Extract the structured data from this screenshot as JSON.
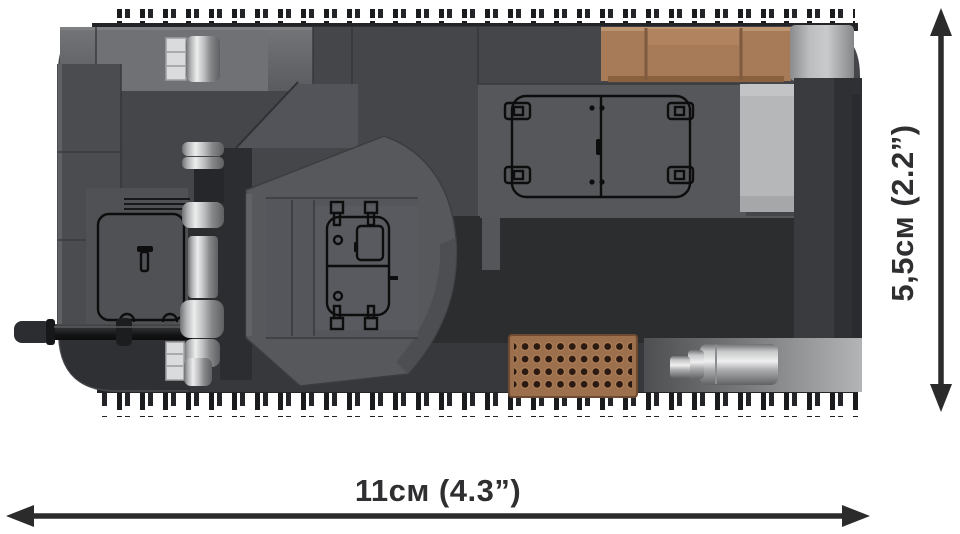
{
  "meta": {
    "description": "Product dimension image: top view of a brick-built (COBI-style) grey tank model with black dimension arrows on white background",
    "view": "top",
    "background": "#ffffff"
  },
  "dimensions": {
    "width_label": "11см (4.3”)",
    "height_label": "5,5см (2.2”)",
    "arrow_color": "#2b2b2c",
    "label_color": "#2f2f31"
  },
  "colors": {
    "background": "#ffffff",
    "hull": "#454649",
    "hull_front_light": "#656669",
    "sponson_dark": "#2c2d2f",
    "turret": "#57585c",
    "engine_deck": "#55575a",
    "crate_brown": "#a87b58",
    "grate_brown": "#9c6f4d",
    "grate_hole": "#2b1a11",
    "light_panel": "#b6b7b8",
    "track": "#1d1e1f",
    "silver": "#c9cacc",
    "print_black": "#0d0d0e",
    "arrow": "#2b2b2c",
    "label": "#2f2f31"
  },
  "model": {
    "parts": [
      {
        "name": "gun-barrel",
        "color": "#1d1e20"
      },
      {
        "name": "gun-mantlet-rings",
        "color": "#c9cacc"
      },
      {
        "name": "turret",
        "color": "#57585c"
      },
      {
        "name": "turret-hatch-print",
        "color": "#0d0d0e"
      },
      {
        "name": "driver-hatch-print",
        "color": "#0d0d0e"
      },
      {
        "name": "engine-deck-hatch-print",
        "color": "#0d0d0e"
      },
      {
        "name": "cargo-crates",
        "color": "#a87b58"
      },
      {
        "name": "engine-vent-grate",
        "color": "#9c6f4d"
      },
      {
        "name": "exhaust-muffler",
        "color": "#c9cacc"
      },
      {
        "name": "headlight",
        "color": "#c9cacc"
      },
      {
        "name": "rear-light-panel",
        "color": "#b6b7b8"
      },
      {
        "name": "tracks",
        "color": "#1d1e1f"
      },
      {
        "name": "hull",
        "color": "#454649"
      }
    ]
  }
}
